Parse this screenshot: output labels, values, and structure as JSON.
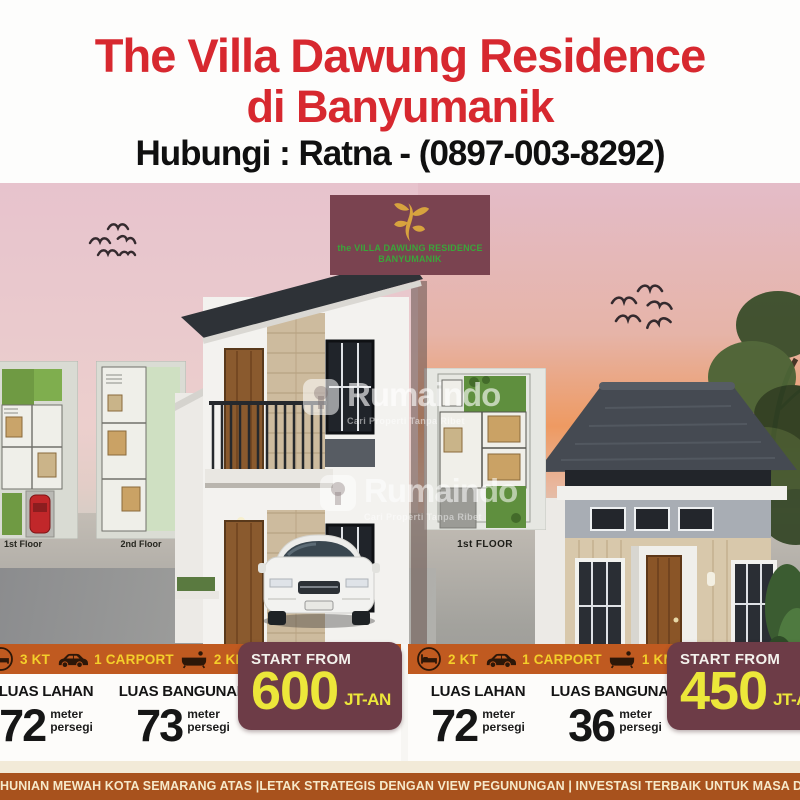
{
  "header": {
    "title_line1": "The Villa Dawung Residence",
    "title_line2": "di Banyumanik",
    "contact": "Hubungi : Ratna - (0897-003-8292)"
  },
  "logo_badge": {
    "icon": "plant-flourish-icon",
    "line1": "the VILLA DAWUNG RESIDENCE",
    "line2": "BANYUMANIK"
  },
  "watermark": {
    "logo_icon": "rumaindo-logo-icon",
    "brand": "Rumaindo",
    "tagline": "Cari Properti Tanpa Ribet"
  },
  "floor_plans": {
    "left_first": "1st Floor",
    "left_second": "2nd Floor",
    "middle": "1st FLOOR"
  },
  "units": [
    {
      "specs": [
        {
          "icon": "bed-icon",
          "label": "3 KT"
        },
        {
          "icon": "car-icon",
          "label": "1 CARPORT"
        },
        {
          "icon": "bathtub-icon",
          "label": "2 KM"
        }
      ],
      "land": {
        "title": "LUAS LAHAN",
        "value": "72",
        "unit_line1": "meter",
        "unit_line2": "persegi"
      },
      "building": {
        "title": "LUAS BANGUNAN",
        "value": "73",
        "unit_line1": "meter",
        "unit_line2": "persegi"
      },
      "price": {
        "label": "START FROM",
        "value": "600",
        "suffix": "JT-AN"
      }
    },
    {
      "specs": [
        {
          "icon": "bed-icon",
          "label": "2 KT"
        },
        {
          "icon": "car-icon",
          "label": "1 CARPORT"
        },
        {
          "icon": "bathtub-icon",
          "label": "1 KM"
        }
      ],
      "land": {
        "title": "LUAS LAHAN",
        "value": "72",
        "unit_line1": "meter",
        "unit_line2": "persegi"
      },
      "building": {
        "title": "LUAS BANGUNAN",
        "value": "36",
        "unit_line1": "meter",
        "unit_line2": "persegi"
      },
      "price": {
        "label": "START FROM",
        "value": "450",
        "suffix": "JT-AN"
      }
    }
  ],
  "footer": {
    "text": "HUNIAN MEWAH KOTA SEMARANG ATAS |LETAK STRATEGIS DENGAN VIEW PEGUNUNGAN | INVESTASI TERBAIK UNTUK MASA DEPAN"
  },
  "colors": {
    "accent_red": "#d7282f",
    "orange_bar": "#c05a20",
    "maroon_badge": "#6d3c47",
    "logo_green": "#3aa53a",
    "price_yellow": "#ece73a",
    "footer_brown": "#a8521d"
  }
}
